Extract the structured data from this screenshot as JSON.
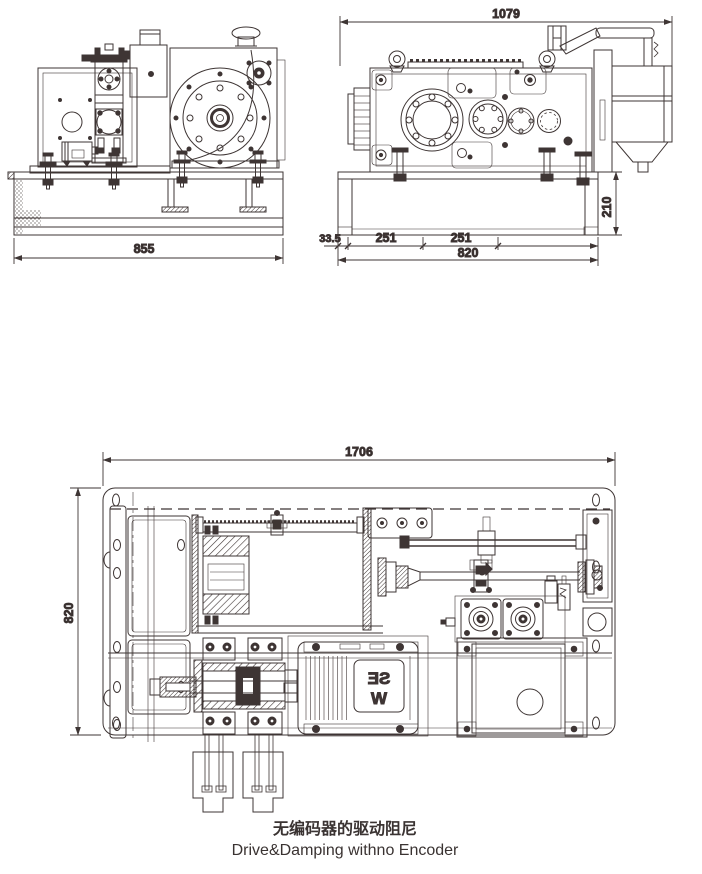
{
  "drawing": {
    "background": "#ffffff",
    "line_color": "#3E3534",
    "caption": {
      "title_zh": "无编码器的驱动阻尼",
      "title_en": "Drive&Damping withno Encoder"
    },
    "views": {
      "front": {
        "dims": {
          "overall_width": "855"
        }
      },
      "side": {
        "dims": {
          "overall_length": "1079",
          "base_height": "210",
          "seg_a": "33.5",
          "seg_b": "251",
          "seg_c": "251",
          "base_length": "820"
        }
      },
      "plan": {
        "dims": {
          "overall_length": "1706",
          "overall_depth": "820"
        },
        "motor_brand_top": "SE",
        "motor_brand_bottom": "W"
      }
    }
  }
}
